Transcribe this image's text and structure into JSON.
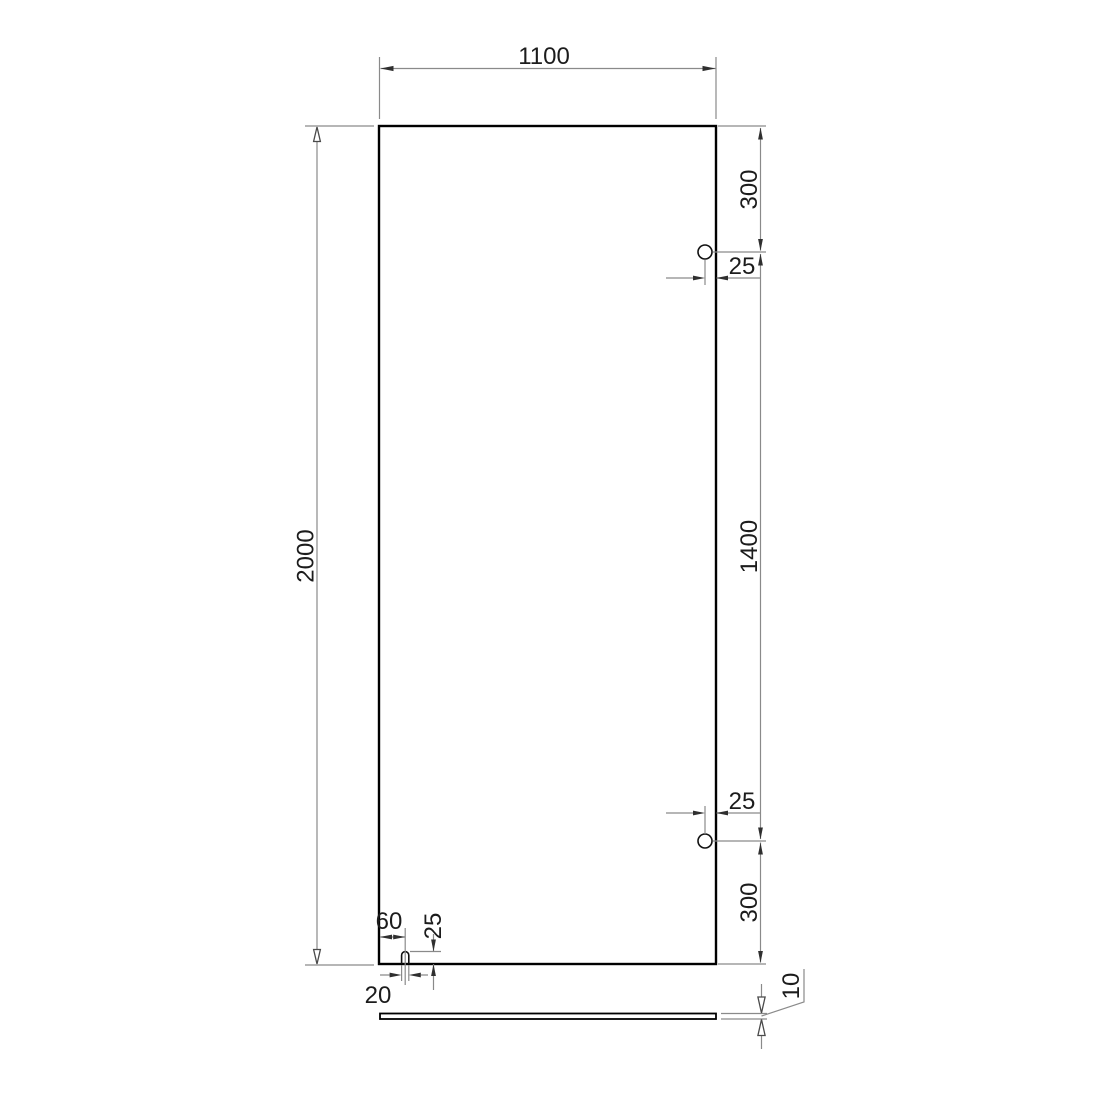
{
  "colors": {
    "background": "#ffffff",
    "outline": "#000000",
    "dimension_lines": "#8a8a8a",
    "text": "#1c1c1c"
  },
  "front_view": {
    "width": "1100",
    "height": "2000",
    "hole_top_from_top_edge": "300",
    "hole_to_hole": "1400",
    "hole_bottom_from_bottom_edge": "300",
    "hole_top_from_right_edge": "25",
    "hole_bottom_from_right_edge": "25",
    "slot_center_from_left_edge": "60",
    "slot_depth": "25",
    "slot_width": "20"
  },
  "side_view": {
    "thickness": "10"
  }
}
